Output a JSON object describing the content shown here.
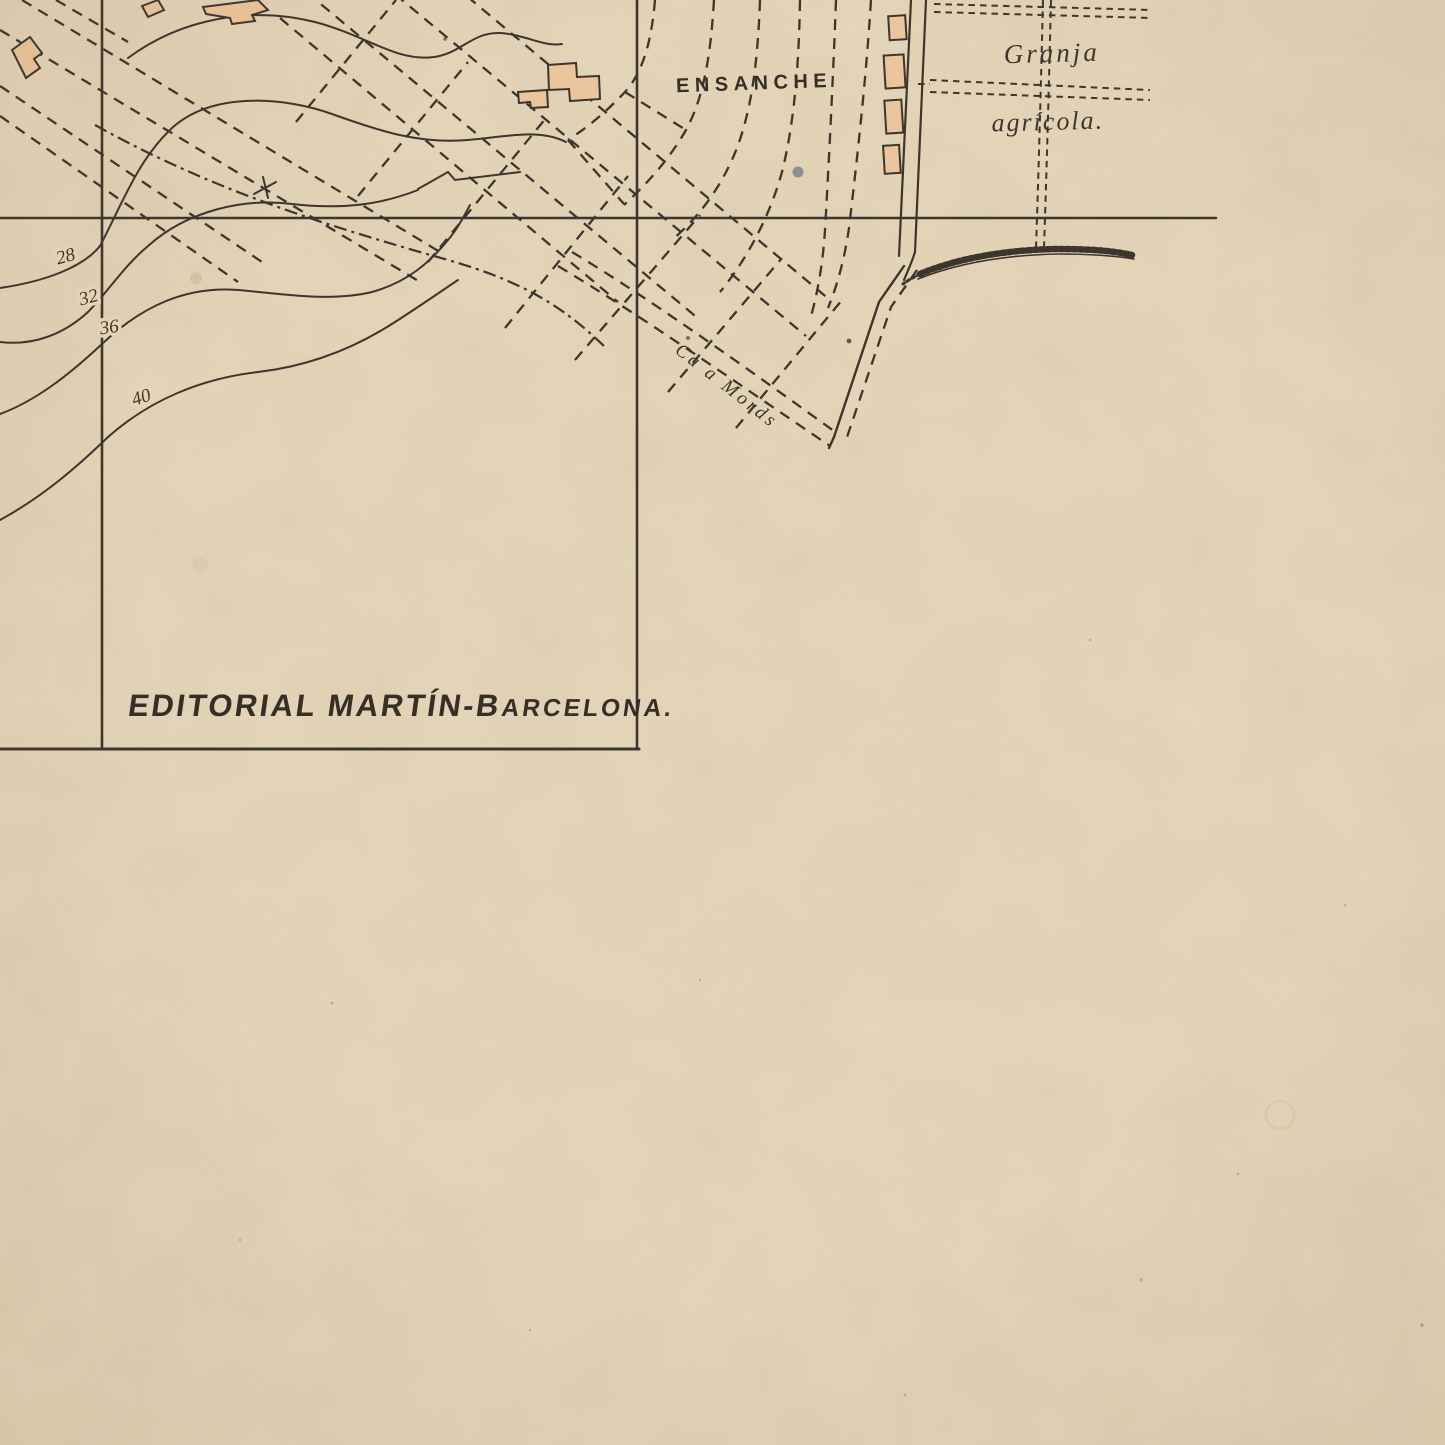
{
  "map": {
    "region_labels": {
      "ensanche": "ENSANCHE",
      "granja": "Granja",
      "agricola": "agrícola.",
      "road": "Ca a Mords"
    },
    "imprint": {
      "main": "EDITORIAL MARTÍN-B",
      "tail": "ARCELONA."
    },
    "contour_labels": [
      "28",
      "32",
      "36",
      "40"
    ],
    "colors": {
      "paper": "#e9d9bd",
      "ink": "#3a332b",
      "building": "#eec79e",
      "blue_fleck": "#74808c"
    }
  }
}
